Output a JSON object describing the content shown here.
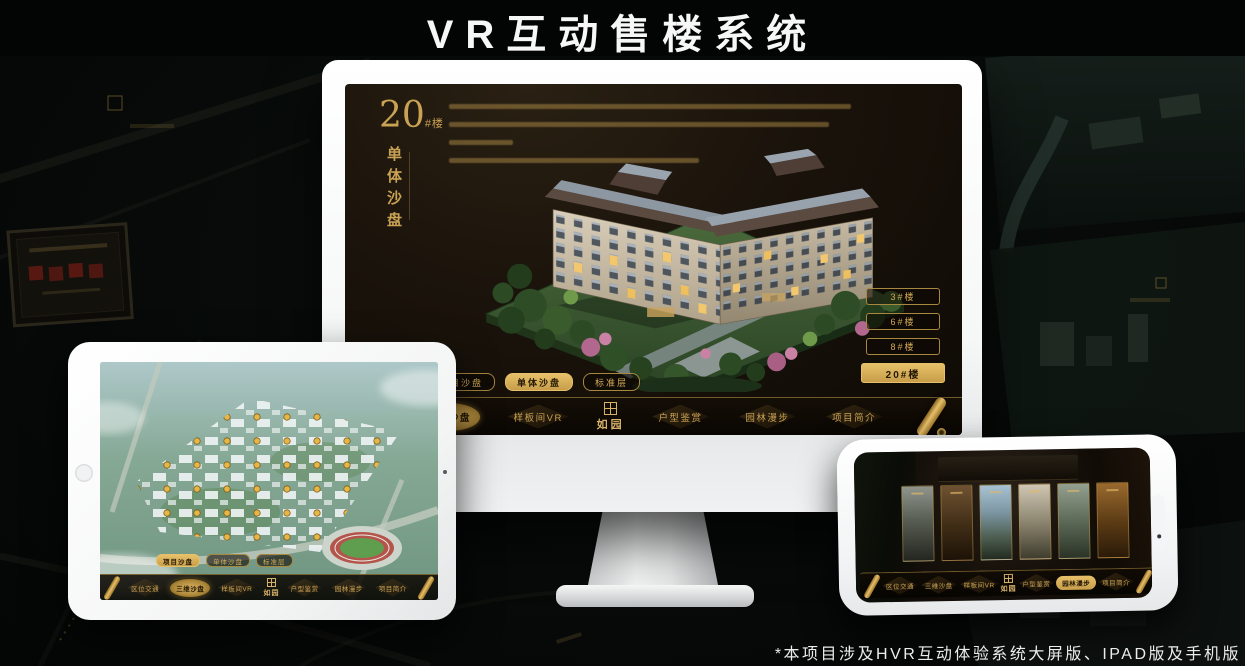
{
  "title": "VR互动售楼系统",
  "footnote": "*本项目涉及HVR互动体验系统大屏版、IPAD版及手机版",
  "brand": {
    "name": "如园"
  },
  "colors": {
    "gold": "#c9a254",
    "gold_bright": "#e7c169",
    "screen_bg": "#17110a",
    "dark_text": "#241806"
  },
  "nav_items": [
    "区位交通",
    "三维沙盘",
    "样板间VR",
    "户型鉴赏",
    "园林漫步",
    "项目简介"
  ],
  "sub_tabs": [
    "项目沙盘",
    "单体沙盘",
    "标准层"
  ],
  "monitor": {
    "heading_number": "20",
    "heading_suffix": "#楼",
    "heading_title_vertical": "单体沙盘",
    "floor_buttons": [
      "3#楼",
      "6#楼",
      "8#楼",
      "20#楼"
    ],
    "active_floor": "20#楼",
    "active_sub_tab": "单体沙盘",
    "active_nav_item": "三维沙盘"
  },
  "ipad": {
    "active_sub_tab": "项目沙盘",
    "active_nav_item": "三维沙盘"
  },
  "phone": {
    "active_nav_item": "园林漫步"
  }
}
